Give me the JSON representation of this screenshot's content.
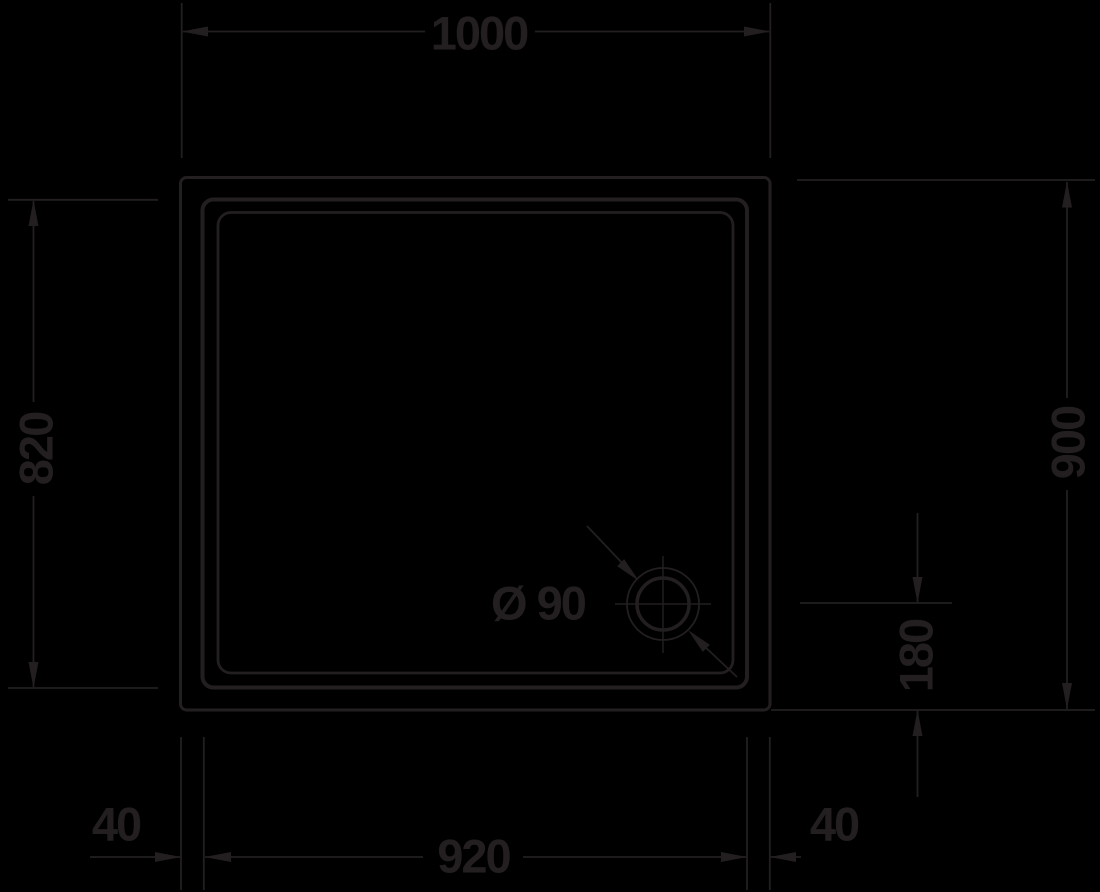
{
  "canvas": {
    "width": 1100,
    "height": 892,
    "background": "#000000",
    "ink": "#231f20"
  },
  "drawing": {
    "type": "technical-drawing",
    "subject": "square shower tray plan view with corner drain",
    "dimensions": {
      "outer_width": "1000",
      "inner_height": "820",
      "outer_height": "900",
      "drain_offset": "180",
      "drain_diameter": "Ø 90",
      "bottom_left_margin": "40",
      "inner_width": "920",
      "bottom_right_margin": "40"
    }
  }
}
